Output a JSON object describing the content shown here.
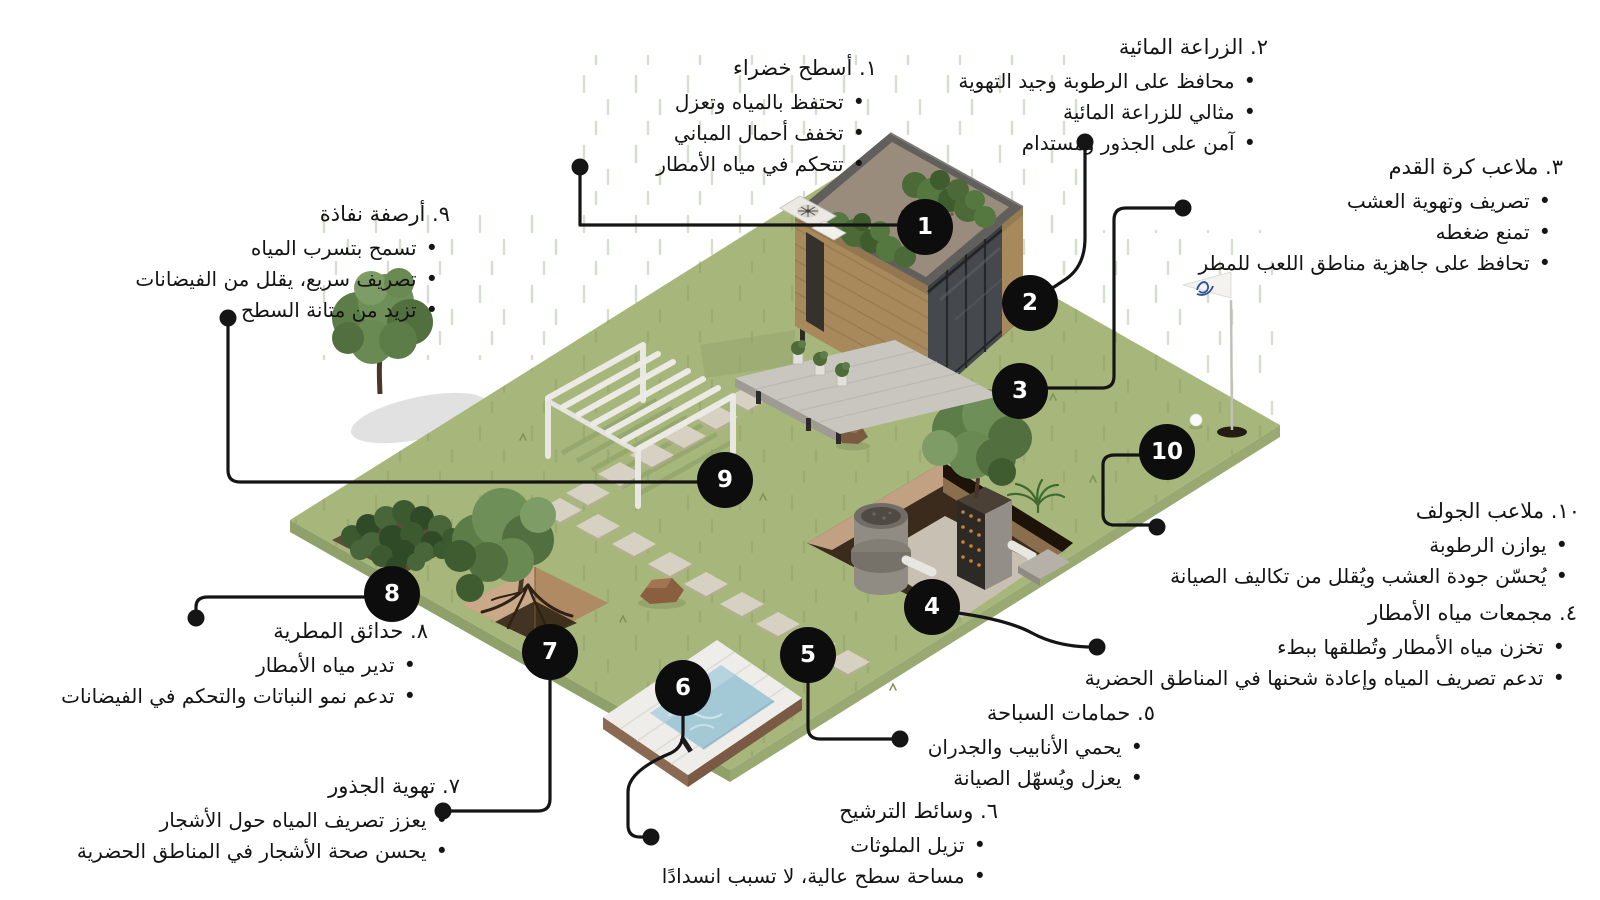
{
  "canvas": {
    "width": 1600,
    "height": 900
  },
  "colors": {
    "background": "#ffffff",
    "text": "#141414",
    "line": "#151515",
    "badge_bg": "#0d0d0d",
    "badge_text": "#ffffff",
    "grass": "#a7b77b",
    "grass_edge": "#90a06b",
    "water": "#a3c8d6",
    "wood": "#a8895c",
    "stone": "#d7d1c3",
    "foliage": "#5d7d48",
    "flag_logo": "#2a4f9e"
  },
  "annotations": [
    {
      "num": "1",
      "title": "١. أسطح خضراء",
      "bullets": [
        "تحتفظ بالمياه وتعزل",
        "تخفف أحمال المباني",
        "تتحكم في مياه الأمطار"
      ]
    },
    {
      "num": "2",
      "title": "٢. الزراعة المائية",
      "bullets": [
        "محافظ على الرطوبة وجيد التهوية",
        "مثالي للزراعة المائية",
        "آمن على الجذور ومستدام"
      ]
    },
    {
      "num": "3",
      "title": "٣. ملاعب كرة القدم",
      "bullets": [
        "تصريف وتهوية العشب",
        "تمنع ضغطه",
        "تحافظ على جاهزية مناطق اللعب للمطر"
      ]
    },
    {
      "num": "4",
      "title": "٤. مجمعات مياه الأمطار",
      "bullets": [
        "تخزن مياه الأمطار وتُطلقها ببطء",
        "تدعم تصريف المياه وإعادة شحنها في المناطق الحضرية"
      ]
    },
    {
      "num": "5",
      "title": "٥. حمامات السباحة",
      "bullets": [
        "يحمي الأنابيب والجدران",
        "يعزل ويُسهّل الصيانة"
      ]
    },
    {
      "num": "6",
      "title": "٦. وسائط الترشيح",
      "bullets": [
        "تزيل الملوثات",
        "مساحة سطح عالية، لا تسبب انسدادًا"
      ]
    },
    {
      "num": "7",
      "title": "٧. تهوية الجذور",
      "bullets": [
        "يعزز تصريف المياه حول الأشجار",
        "يحسن صحة الأشجار في المناطق الحضرية"
      ]
    },
    {
      "num": "8",
      "title": "٨. حدائق المطرية",
      "bullets": [
        "تدير مياه الأمطار",
        "تدعم نمو النباتات والتحكم في الفيضانات"
      ]
    },
    {
      "num": "9",
      "title": "٩. أرصفة نفاذة",
      "bullets": [
        "تسمح بتسرب المياه",
        "تصريف سريع، يقلل من الفيضانات",
        "تزيد من متانة السطح"
      ]
    },
    {
      "num": "10",
      "title": "١٠. ملاعب الجولف",
      "bullets": [
        "يوازن الرطوبة",
        "يُحسّن جودة العشب ويُقلل من تكاليف الصيانة"
      ]
    }
  ]
}
